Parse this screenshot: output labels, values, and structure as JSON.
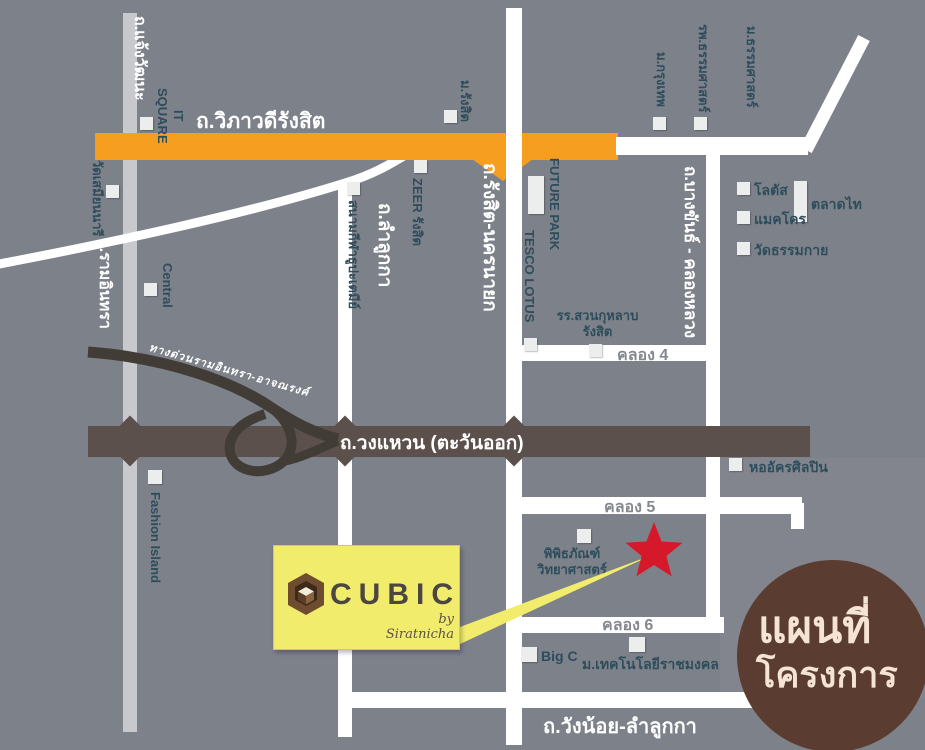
{
  "map": {
    "title": "CUBIC project location map",
    "roads": {
      "vibhavadi": "ถ.วิภาวดีรังสิต",
      "chaengwattana": "ถ.แจ้งวัฒนะ",
      "ramindra": "ถ.รามอินทรา",
      "lamlukka": "ถ.ลำลูกกา",
      "rangsit_nakhonnayok": "ถ.รังสิต-นครนายก",
      "bangkhan_khlongluang": "ถ.บางขันธ์ - คลองหลวง",
      "outer_ring": "ถ.วงแหวน (ตะวันออก)",
      "expressway": "ทางด่วนรามอินทรา-อาจณรงค์",
      "khlong4": "คลอง 4",
      "khlong5": "คลอง 5",
      "khlong6": "คลอง 6",
      "wangnoi_lamlukka": "ถ.วังน้อย-ลำลูกกา"
    },
    "landmarks": {
      "it_square": "IT\nSQUARE",
      "wat_samiannari": "วัดเสมียนนารี",
      "central": "Central",
      "fashion_island": "Fashion Island",
      "rangsit_university": "ม.รังสิต",
      "zeer_rangsit": "ZEER รังสิต",
      "thupatemi_stadium": "สนามกีฬาธูปะเตมีย์",
      "future_park": "FUTURE PARK",
      "tesco_lotus": "TESCO LOTUS",
      "suankularb_line1": "รร.สวนกุหลาบ",
      "suankularb_line2": "รังสิต",
      "bangkok_university": "ม.กรุงเทพ",
      "thammasat_hospital": "รพ.ธรรมศาสตร์",
      "thammasat_university": "ม.ธรรมศาสตร์",
      "lotus": "โลตัส",
      "makro": "แมคโคร",
      "talad_thai": "ตลาดไท",
      "wat_dhammakaya": "วัดธรรมกาย",
      "supreme_artist_hall": "หออัครศิลปิน",
      "science_museum_line1": "พิพิธภัณฑ์",
      "science_museum_line2": "วิทยาศาสตร์",
      "big_c": "Big C",
      "rmutt": "ม.เทคโนโลยีราชมงคล"
    },
    "logo": {
      "brand": "CUBIC",
      "byline": "by Siratnicha"
    },
    "badge": {
      "line1": "แผนที่",
      "line2": "โครงการ"
    },
    "colors": {
      "background": "#7d8189",
      "road_white": "#ffffff",
      "road_gray": "#c7c9cc",
      "road_orange": "#f59e20",
      "ring_road": "#5c504c",
      "expressway": "#423c36",
      "landmark_text": "#2e4d5c",
      "star_red": "#d6182b",
      "logo_yellow": "#f2ec6d",
      "badge_brown": "#5a3d30",
      "badge_text": "#f5e3d3"
    }
  }
}
